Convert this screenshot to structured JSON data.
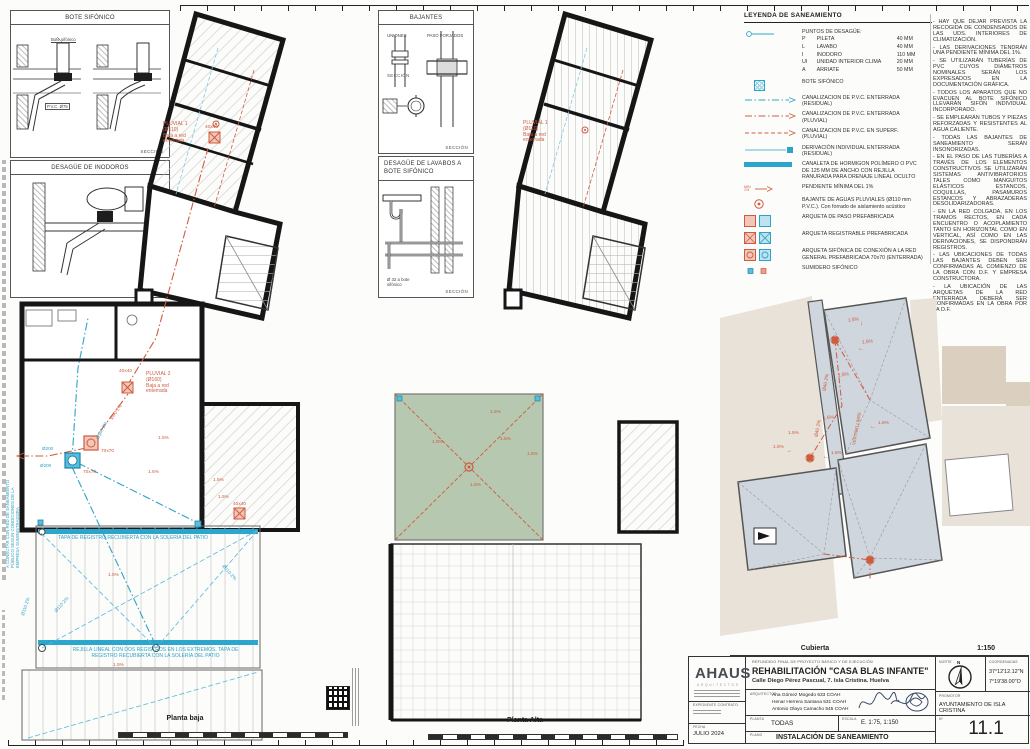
{
  "sheet": {
    "planta_baja_label": "Planta baja",
    "planta_alta_label": "Planta Alta",
    "cubierta_label": "Cubierta",
    "cubierta_scale": "1:150"
  },
  "details": {
    "bote": {
      "title": "BOTE SIFÓNICO",
      "callout": "Bote sifónico",
      "pipe": "P.V.C. Ø75",
      "seccion": "SECCIÓN"
    },
    "inodoros": {
      "title": "DESAGÜE DE INODOROS",
      "seccion": "SECCIÓN"
    },
    "bajantes": {
      "title": "BAJANTES",
      "uniones": "UNIONES",
      "paso": "PASO FORJADOS",
      "seccion1": "SECCIÓN",
      "seccion2": "SECCIÓN"
    },
    "lavabos": {
      "title": "DESAGÜE DE LAVABOS A BOTE SIFÓNICO",
      "callout": "Ø 32 a bote sifónico",
      "seccion": "SECCIÓN"
    }
  },
  "legend": {
    "title": "LEYENDA DE SANEAMIENTO",
    "drain_points": {
      "label": "PUNTOS DE DESAGÜE:",
      "rows": [
        {
          "code": "P",
          "name": "PILETA",
          "size": "40 MM"
        },
        {
          "code": "L",
          "name": "LAVABO",
          "size": "40 MM"
        },
        {
          "code": "I",
          "name": "INODORO",
          "size": "110 MM"
        },
        {
          "code": "UI",
          "name": "UNIDAD INTERIOR CLIMA",
          "size": "20 MM"
        },
        {
          "code": "A",
          "name": "ARRIATE",
          "size": "50 MM"
        }
      ]
    },
    "pendiente_icon": "MIN\n1%",
    "items": [
      {
        "label": "BOTE SIFÓNICO"
      },
      {
        "label": "CANALIZACION DE P.V.C. ENTERRADA (RESIDUAL)"
      },
      {
        "label": "CANALIZACION DE P.V.C. ENTERRADA (PLUVIAL)"
      },
      {
        "label": "CANALIZACION DE P.V.C. EN SUPERF. (PLUVIAL)"
      },
      {
        "label": "DERIVACIÓN INDIVIDUAL ENTERRADA (RESIDUAL)"
      },
      {
        "label": "CANALETA DE HORMIGON POLÍMERO O PVC DE 125 MM DE ANCHO CON REJILLA RANURADA PARA DRENAJE LINEAL OCULTO"
      },
      {
        "label": "PENDIENTE MÍNIMA DEL 1%"
      },
      {
        "label": "BAJANTE DE AGUAS PLUVIALES (Ø110 mm P.V.C.). Con forrado de aislamiento acústico"
      },
      {
        "label": "ARQUETA DE PASO PREFABRICADA"
      },
      {
        "label": "ARQUETA REGISTRABLE PREFABRICADA"
      },
      {
        "label": "ARQUETA SIFÓNICA DE CONEXIÓN A LA RED GENERAL PREFABRICADA 70x70 (ENTERRADA)"
      },
      {
        "label": "SUMIDERO SIFÓNICO"
      }
    ]
  },
  "notes": [
    "- HAY QUE DEJAR PREVISTA LA RECOGIDA DE CONDENSADOS DE LAS UDS. INTERIORES DE CLIMATIZACIÓN.",
    "- LAS DERIVACIONES TENDRÁN UNA PENDIENTE MÍNIMA DEL 1%.",
    "- SE UTILIZARÁN TUBERÍAS DE PVC CUYOS DIÁMETROS NOMINALES SERÁN LOS EXPRESADOS EN LA DOCUMENTACIÓN GRÁFICA.",
    "- TODOS LOS APARATOS QUE NO EVACUEN AL BOTE SIFÓNICO LLEVARÁN SIFÓN INDIVIDUAL INCORPORADO.",
    "- SE EMPLEARÁN TUBOS Y PIEZAS REFORZADAS Y RESISTENTES AL AGUA CALIENTE.",
    "- TODAS LAS BAJANTES DE SANEAMIENTO SERÁN INSONORIZADAS.",
    "- EN EL PASO DE LAS TUBERÍAS A TRAVÉS DE LOS ELEMENTOS CONSTRUCTIVOS SE UTILIZARÁN SISTEMAS ANTIVIBRATORIOS TALES COMO MANGUITOS ELÁSTICOS ESTANCOS, COQUILLAS, PASAMUROS ESTANCOS Y ABRAZADERAS DESOLIDARIZADORAS.",
    "- EN LA RED COLGADA, EN LOS TRAMOS RECTOS, EN CADA ENCUENTRO O ACOPLAMIENTO TANTO EN HORIZONTAL COMO EN VERTICAL, ASÍ COMO EN LAS DERIVACIONES, SE DISPONDRÁN REGISTROS.",
    "- LAS UBICACIONES DE TODAS LAS BAJANTES DEBEN SER CONFIRMADAS AL COMIENZO DE LA OBRA CON D.F. Y EMPRESA CONSTRUCTORA.",
    "- LA UBICACIÓN DE LAS ARQUETAS DE LA RED ENTERRADA DEBERÁ SER CONFIRMADAS EN LA OBRA POR LA D.F."
  ],
  "plans": {
    "pluvial1": "PLUVIAL 1\n(Ø110)\nBaja a red\nenterrada",
    "pluvial2": "PLUVIAL 2\n(Ø160)\nBaja a red\nenterrada",
    "rejilla_uno": "REJILLA LINEAL CON UN REGISTRO EN EL EXTREMO\nTAPA DE REGISTRO RECUBIERTA CON LA SOLERÍA DEL PATIO",
    "rejilla_dos": "REJILLA LINEAL CON DOS REGISTROS EN LOS EXTREMOS. TAPA DE\nREGISTRO RECUBIERTA CON LA SOLERÍA DEL PATIO",
    "conectar": "A CONECTAR CON RED DE SANEAMIENTO\nPÚBLICO SEGÚN CONDICIONES DE LA\nEMPRESA SUMINISTRADORA",
    "labels": {
      "slope": "1.5%",
      "d110": "Ø110 2%",
      "d160": "Ø160 2%",
      "d90": "Ø90 2%",
      "d200": "Ø200",
      "d40": "Ø40 2%",
      "s70": "70x70",
      "s40": "40x40",
      "vertido": "VERTIDO LIBRE"
    }
  },
  "icons": {
    "arrow_down": "↓",
    "arrow_up": "↑",
    "arrow_left": "←",
    "arrow_right": "→"
  },
  "title_block": {
    "firm_name": "AHAUS",
    "firm_sub": "ARQUITECTOS",
    "refundido": "REFUNDIDO FINAL DE PROYECTO BÁSICO Y DE EJECUCIÓN",
    "project": "REHABILITACIÓN \"CASA BLAS INFANTE\"",
    "address": "Calle Diego Pérez Pascual, 7. Isla Cristina. Huelva",
    "arquitectos_label": "ARQUITECTOS",
    "architect_1": "Ana Gómez Mogedo 633 COAH",
    "architect_2": "Henar Herrera Santana 531 COAH",
    "architect_3": "Antonio Olayo Camacho 545 COAH",
    "norte_label": "NORTE",
    "norte_n": "N",
    "coordenadas_label": "COORDENADAS",
    "coord_lat": "37°12'12.12\"N",
    "coord_lon": "7°19'38.00\"O",
    "promotor_label": "PROMOTOR",
    "promotor": "AYUNTAMIENTO DE ISLA CRISTINA",
    "expediente_label": "EXPEDIENTE CONTRATO",
    "fecha_label": "FECHA",
    "fecha": "JULIO 2024",
    "planta_label": "PLANTA",
    "planta": "TODAS",
    "escala_label": "ESCALA",
    "escala": "E. 1:75, 1:150",
    "plano_label": "PLANO",
    "plano": "INSTALACIÓN DE SANEAMIENTO",
    "num_label": "Nº",
    "num": "11.1"
  }
}
